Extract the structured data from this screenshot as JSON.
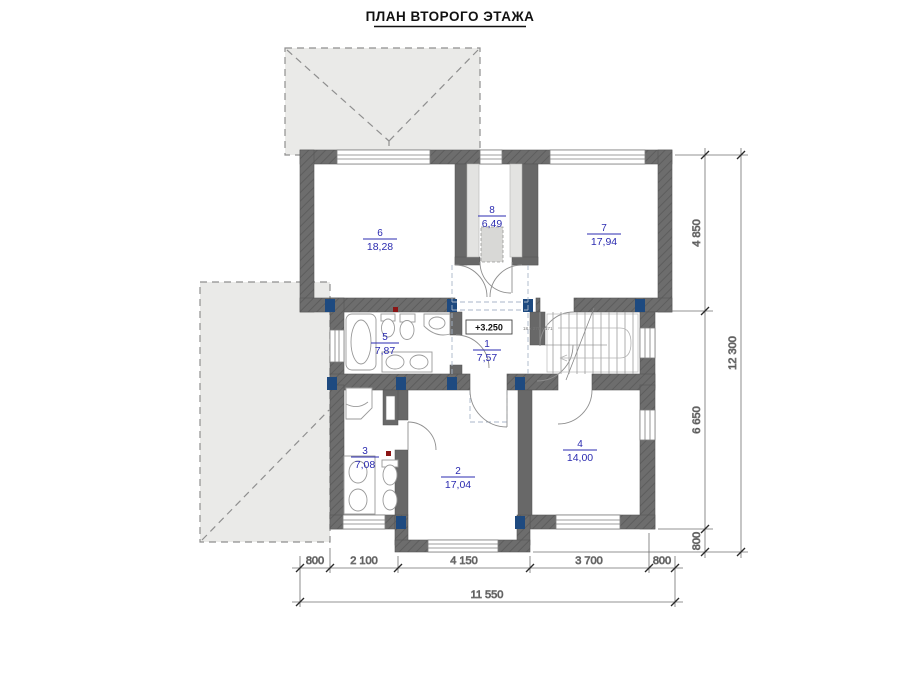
{
  "title": "ПЛАН ВТОРОГО ЭТАЖА",
  "rooms": {
    "r1": {
      "number": "1",
      "area": "7,57"
    },
    "r2": {
      "number": "2",
      "area": "17,04"
    },
    "r3": {
      "number": "3",
      "area": "7,08"
    },
    "r4": {
      "number": "4",
      "area": "14,00"
    },
    "r5": {
      "number": "5",
      "area": "7,87"
    },
    "r6": {
      "number": "6",
      "area": "18,28"
    },
    "r7": {
      "number": "7",
      "area": "17,94"
    },
    "r8": {
      "number": "8",
      "area": "6,49"
    }
  },
  "elevation_marker": "+3.250",
  "stair_note": "18 x 270 x 171",
  "dims": {
    "right_segments": [
      "4 850",
      "6 650",
      "800"
    ],
    "right_total": "12 300",
    "bottom_segments": [
      "800",
      "2 100",
      "4 150",
      "3 700",
      "800"
    ],
    "bottom_total": "11 550"
  },
  "colors": {
    "wall": "#6d6d6d",
    "roof_fill": "#eaeae8",
    "room_label": "#2b2bb0",
    "column": "#1e4a80",
    "fixture": "#9a9a9a",
    "red_marker": "#8b1515"
  }
}
